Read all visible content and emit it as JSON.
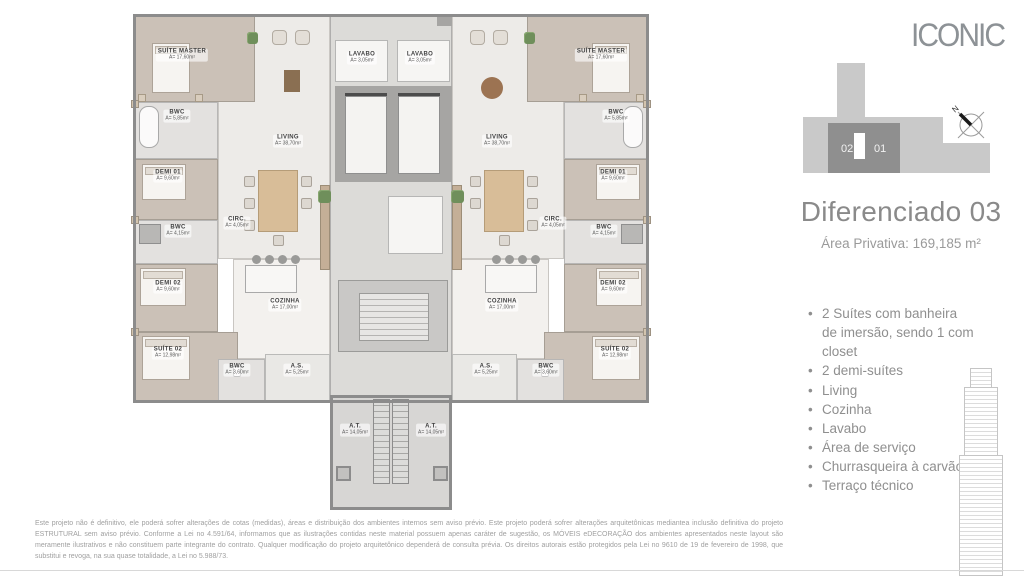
{
  "brand": {
    "logo_text": "ICONIC"
  },
  "keyplan": {
    "unit_left": "02",
    "unit_right": "01",
    "north_label": "N"
  },
  "header": {
    "title": "Diferenciado 03",
    "subtitle": "Área Privativa: 169,185 m²"
  },
  "features": {
    "items": [
      "2 Suítes com banheira de imersão, sendo 1 com closet",
      "2 demi-suítes",
      "Living",
      "Cozinha",
      "Lavabo",
      "Área de serviço",
      "Churrasqueira à carvão",
      "Terraço técnico"
    ]
  },
  "disclaimer": {
    "text": "Este projeto não é definitivo, ele poderá sofrer alterações de cotas (medidas), áreas e distribuição dos ambientes internos sem aviso prévio. Este projeto poderá sofrer alterações arquitetônicas mediantea inclusão definitiva do projeto ESTRUTURAL sem aviso prévio. Conforme a Lei no 4.591/64, informamos que as ilustrações contidas neste material possuem apenas caráter de sugestão, os MÓVEIS eDECORAÇÃO dos ambientes apresentados neste layout são meramente ilustrativos e não constituem parte integrante do contrato. Qualquer modificação do projeto arquitetônico dependerá de consulta prévia. Os direitos autorais estão protegidos pela Lei no 9610 de 19 de fevereiro de 1998, que substitui e revoga, na sua quase totalidade, a Lei no 5.988/73."
  },
  "floorplan": {
    "rooms": [
      {
        "name": "SUÍTE MASTER",
        "area": "A= 17,60m²"
      },
      {
        "name": "BWC",
        "area": "A= 5,85m²"
      },
      {
        "name": "DEMI 01",
        "area": "A= 9,60m²"
      },
      {
        "name": "BWC",
        "area": "A= 4,15m²"
      },
      {
        "name": "DEMI 02",
        "area": "A= 9,60m²"
      },
      {
        "name": "SUÍTE 02",
        "area": "A= 12,98m²"
      },
      {
        "name": "LIVING",
        "area": "A= 38,70m²"
      },
      {
        "name": "CIRC.",
        "area": "A= 4,05m²"
      },
      {
        "name": "COZINHA",
        "area": "A= 17,00m²"
      },
      {
        "name": "BWC",
        "area": "A= 3,60m²"
      },
      {
        "name": "A.S.",
        "area": "A= 5,25m²"
      },
      {
        "name": "LAVABO",
        "area": "A= 3,05m²"
      },
      {
        "name": "LAVABO",
        "area": "A= 3,05m²"
      },
      {
        "name": "A.T.",
        "area": "A= 14,05m²"
      },
      {
        "name": "A.T.",
        "area": "A= 14,05m²"
      },
      {
        "name": "SUÍTE MASTER",
        "area": "A= 17,60m²"
      },
      {
        "name": "BWC",
        "area": "A= 5,85m²"
      },
      {
        "name": "DEMI 01",
        "area": "A= 9,60m²"
      },
      {
        "name": "BWC",
        "area": "A= 4,15m²"
      },
      {
        "name": "DEMI 02",
        "area": "A= 9,60m²"
      },
      {
        "name": "SUÍTE 02",
        "area": "A= 12,98m²"
      },
      {
        "name": "LIVING",
        "area": "A= 38,70m²"
      },
      {
        "name": "CIRC.",
        "area": "A= 4,05m²"
      },
      {
        "name": "COZINHA",
        "area": "A= 17,00m²"
      },
      {
        "name": "BWC",
        "area": "A= 3,60m²"
      },
      {
        "name": "A.S.",
        "area": "A= 5,25m²"
      }
    ]
  },
  "colors": {
    "wall": "#8c8c8c",
    "bedroom_floor": "#cbc1b7",
    "living_floor": "#edebe8",
    "core_gray": "#dcdbd8",
    "text_gray": "#8f8f8f"
  }
}
